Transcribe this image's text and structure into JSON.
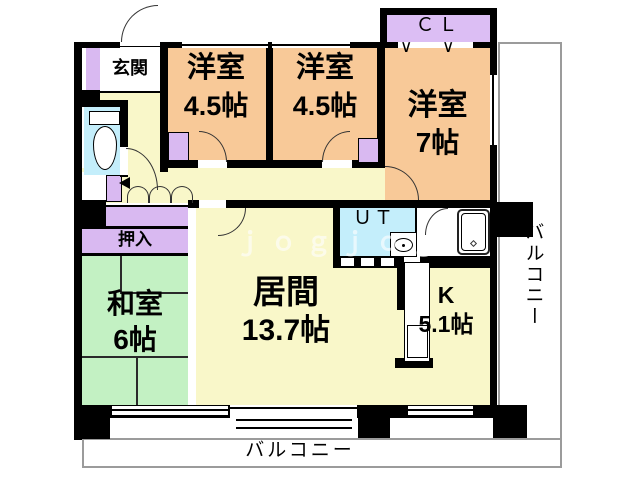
{
  "plan": {
    "entrance": {
      "label": "玄関"
    },
    "bedroom1": {
      "name": "洋室",
      "size": "4.5帖"
    },
    "bedroom2": {
      "name": "洋室",
      "size": "4.5帖"
    },
    "bedroom3": {
      "name": "洋室",
      "size": "7帖"
    },
    "closet_cl": {
      "label": "ＣＬ"
    },
    "utility": {
      "label": "ＵＴ"
    },
    "oshiire": {
      "label": "押入"
    },
    "washitsu": {
      "name": "和室",
      "size": "6帖"
    },
    "living": {
      "name": "居間",
      "size": "13.7帖"
    },
    "kitchen": {
      "name": "K",
      "size": "5.1帖"
    },
    "balcony_bottom": {
      "label": "バルコニー"
    },
    "balcony_right": {
      "label": "バルコニー"
    },
    "hanger_mark": "∨"
  },
  "watermark": {
    "text": "ｊｏｇｊｏｇ"
  },
  "colors": {
    "wall": "#000000",
    "western_room": "#f8c998",
    "living_kitchen_hall": "#f9f7c9",
    "tatami": "#c3f1c3",
    "closet": "#d9b9f1",
    "wet_area": "#c4eefb",
    "balcony_line": "#9b9b9b",
    "watermark": "#ffffff"
  },
  "icons": {
    "toilet-icon": "css ellipse bowl + tank rect",
    "washbasin-icon": "css ellipse + dot in white box",
    "bathtub-icon": "css rounded rect + inner rect + diamond",
    "door-swing-icon": "css quarter-circle arc",
    "folding-door-icon": "css scallop semicircles",
    "hanger-icon": "∨"
  }
}
